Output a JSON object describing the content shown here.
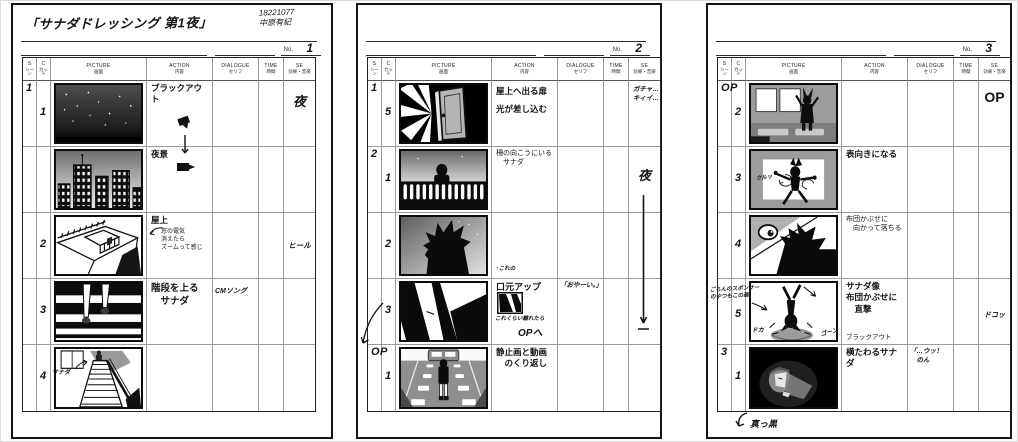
{
  "colors": {
    "paper": "#ffffff",
    "ink": "#141414",
    "grid_line": "#9b9b9b"
  },
  "no_label": "No.",
  "columns": {
    "scene_en": "S",
    "scene_ja": "シーン",
    "cut_en": "C",
    "cut_ja": "カット",
    "picture_en": "PICTURE",
    "picture_ja": "画面",
    "action_en": "ACTION",
    "action_ja": "内容",
    "dialogue_en": "DIALOGUE",
    "dialogue_ja": "セリフ",
    "time_en": "TIME",
    "time_ja": "時間",
    "se_en": "SE",
    "se_ja": "効果・音楽"
  },
  "pages": [
    {
      "number": "1",
      "title": "「サナダドレッシング 第1夜」",
      "credit_id": "18221077",
      "credit_name": "中原有紀",
      "rows": [
        {
          "scene": "1",
          "cut": "1",
          "action": "ブラックアウト",
          "se": "夜"
        },
        {
          "action": "夜景"
        },
        {
          "cut": "2",
          "action": "屋上",
          "action_note": "窓の電気\n消えたら\nズームって感じ",
          "se": "ヒール"
        },
        {
          "cut": "3",
          "action": "階段を上る\n　サナダ",
          "dialogue": "CMソング"
        },
        {
          "cut": "4",
          "picture_label": "サナダ"
        }
      ]
    },
    {
      "number": "2",
      "rows": [
        {
          "scene": "1",
          "cut": "5",
          "action": "屋上へ出る扉\n光が差し込む",
          "se": "ガチャ…\nキィイ…"
        },
        {
          "scene": "2",
          "cut": "1",
          "action": "柵の向こうにいる\n　サナダ",
          "se": "夜"
        },
        {
          "cut": "2",
          "action_note": "↑これの"
        },
        {
          "cut": "3",
          "action": "口元アップ",
          "action_note": "これくらい離れたら",
          "action_note2": "OPへ",
          "dialogue": "「おやーい。」"
        },
        {
          "scene": "OP",
          "cut": "1",
          "action": "静止画と動画\n　のくり返し"
        }
      ]
    },
    {
      "number": "3",
      "rows": [
        {
          "scene": "OP",
          "cut": "2",
          "se": "OP"
        },
        {
          "cut": "3",
          "action": "表向きになる",
          "picture_label": "クルッ"
        },
        {
          "cut": "4",
          "action": "布団かぶせに\n　向かって落ちる"
        },
        {
          "cut": "5",
          "action": "サナダ像\n布団かぶせに\n　直撃",
          "action_note": "ブラックアウト",
          "se": "ドコッ",
          "margin_note": "ごらんのスポンサー\nのやつもこの画",
          "picture_label": "ドカ",
          "picture_label2": "ゴーン"
        },
        {
          "scene": "3",
          "cut": "1",
          "action": "横たわるサナダ",
          "dialogue": "「…ウッ！\n　のん",
          "below_note": "真っ黒"
        }
      ]
    }
  ]
}
